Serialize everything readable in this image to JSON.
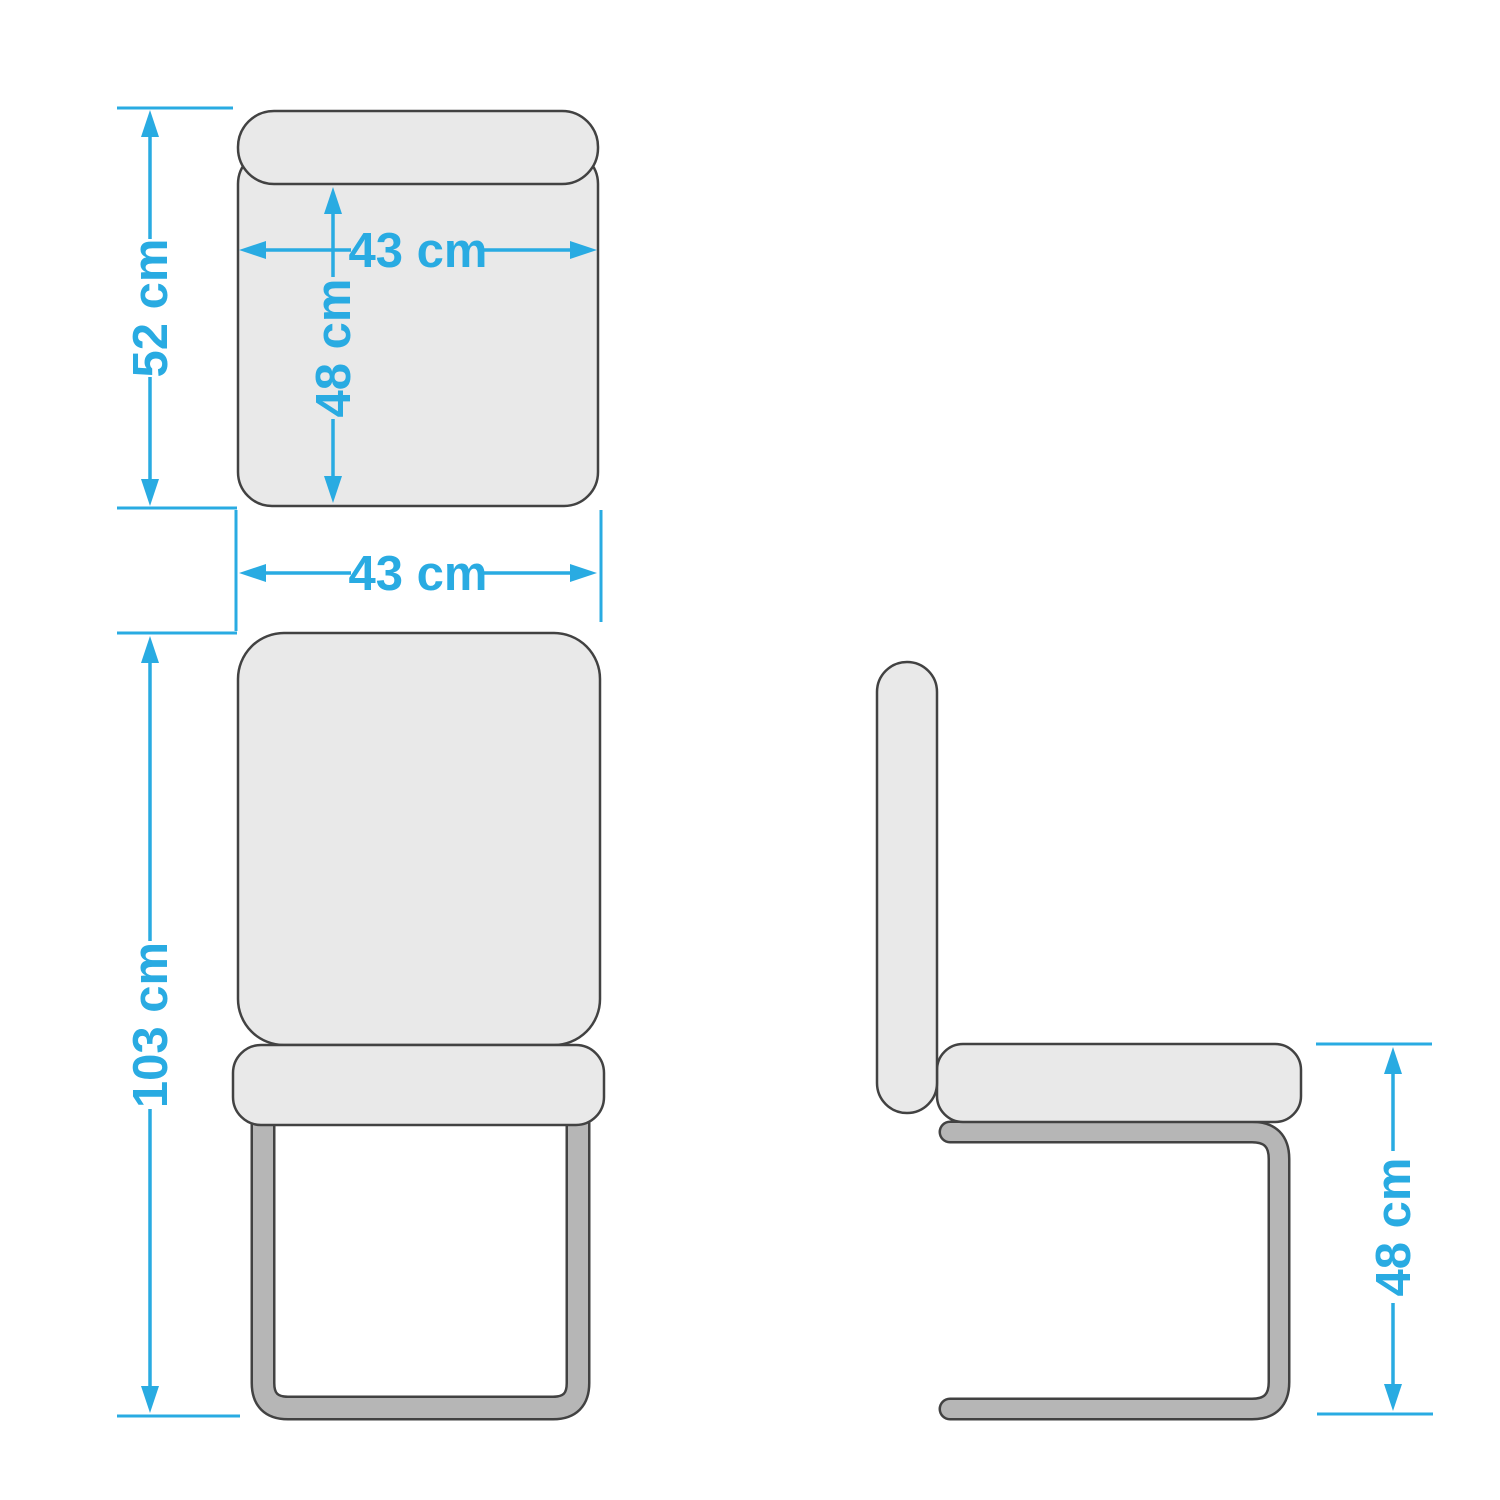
{
  "drawing": {
    "subject": "cantilever chair dimension drawing",
    "views": {
      "top": {
        "name": "top-view",
        "dims": {
          "total_depth": "52 cm",
          "seat_width": "43 cm",
          "seat_depth": "48 cm"
        }
      },
      "front": {
        "name": "front-view",
        "dims": {
          "overall_width": "43 cm",
          "overall_height": "103 cm"
        }
      },
      "side": {
        "name": "side-view",
        "dims": {
          "seat_height": "48 cm"
        }
      }
    }
  },
  "colors": {
    "dimension_blue": "#29ABE2",
    "shape_fill": "#E9E9E9",
    "metal_fill": "#B6B6B6",
    "outline": "#424242",
    "page_background": "#FFFFFF"
  }
}
